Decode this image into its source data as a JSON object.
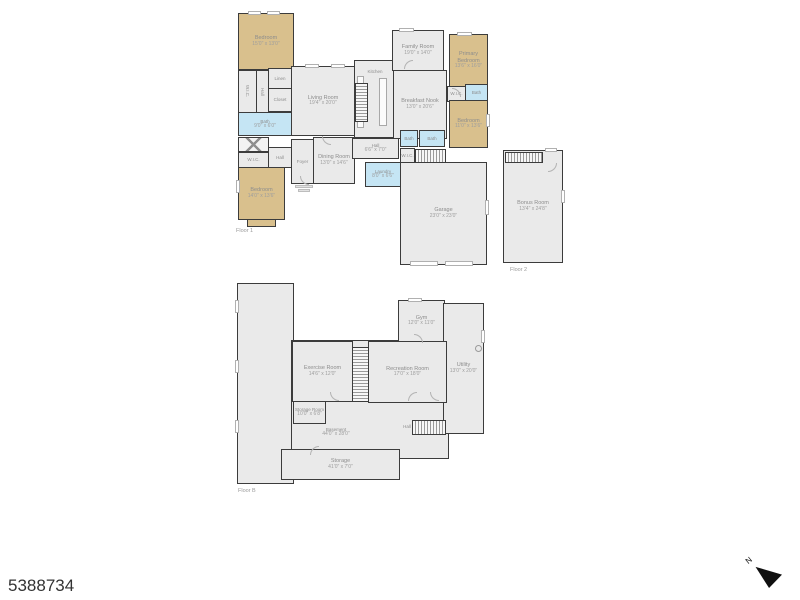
{
  "page": {
    "listing_id": "5388734",
    "compass_label": "N"
  },
  "colors": {
    "wall": "#3c3c3c",
    "room_fill": "#eaeaea",
    "bedroom_fill": "#d9c08d",
    "bath_fill": "#c5e5f4",
    "label_text": "#8d8d8d"
  },
  "floor1": {
    "caption": "Floor 1",
    "rooms": {
      "bedroom_tl": {
        "label": "Bedroom",
        "dims": "15'0\" x 13'0\""
      },
      "wic_a": {
        "label": "W.I.C."
      },
      "hall_a": {
        "label": "Hall"
      },
      "linen": {
        "label": "Linen"
      },
      "closet_a": {
        "label": "Closet"
      },
      "bath_1": {
        "label": "Bath",
        "dims": "9'0\" x 6'0\""
      },
      "wic_b": {
        "label": "W.I.C."
      },
      "hall_b": {
        "label": "Hall"
      },
      "bedroom_bl": {
        "label": "Bedroom",
        "dims": "14'0\" x 13'6\""
      },
      "foyer": {
        "label": "Foyer"
      },
      "dining": {
        "label": "Dining Room",
        "dims": "13'0\" x 14'6\""
      },
      "living": {
        "label": "Living Room",
        "dims": "19'4\" x 20'0\""
      },
      "kitchen": {
        "label": "Kitchen"
      },
      "family": {
        "label": "Family Room",
        "dims": "19'0\" x 14'0\""
      },
      "breakfast": {
        "label": "Breakfast Nook",
        "dims": "13'0\" x 20'6\""
      },
      "primary": {
        "label": "Primary Bedroom",
        "dims": "13'6\" x 16'0\""
      },
      "wic_c": {
        "label": "W.I.C."
      },
      "bath_2": {
        "label": "Bath"
      },
      "bedroom_r": {
        "label": "Bedroom",
        "dims": "11'0\" x 13'6\""
      },
      "hall_c": {
        "label": "Hall",
        "dims": "6'6\" x 7'0\""
      },
      "laundry": {
        "label": "Laundry",
        "dims": "8'0\" x 6'6\""
      },
      "bath_3": {
        "label": "Bath"
      },
      "bath_4": {
        "label": "Bath"
      },
      "wic_d": {
        "label": "W.I.C."
      },
      "garage": {
        "label": "Garage",
        "dims": "23'0\" x 23'0\""
      }
    }
  },
  "floor2": {
    "caption": "Floor 2",
    "rooms": {
      "bonus": {
        "label": "Bonus Room",
        "dims": "13'4\" x 24'8\""
      }
    }
  },
  "basement": {
    "caption": "Floor B",
    "rooms": {
      "exercise": {
        "label": "Exercise Room",
        "dims": "14'6\" x 12'0\""
      },
      "recreation": {
        "label": "Recreation Room",
        "dims": "17'0\" x 18'0\""
      },
      "gym": {
        "label": "Gym",
        "dims": "12'0\" x 11'0\""
      },
      "utility": {
        "label": "Utility",
        "dims": "13'0\" x 20'0\""
      },
      "storage_room": {
        "label": "Storage Room",
        "dims": "10'0\" x 6'8\""
      },
      "storage": {
        "label": "Storage",
        "dims": "41'0\" x 7'0\""
      },
      "hall": {
        "label": "Hall"
      },
      "open": {
        "label": "Basement",
        "dims": "44'0\" x 28'0\""
      }
    }
  }
}
